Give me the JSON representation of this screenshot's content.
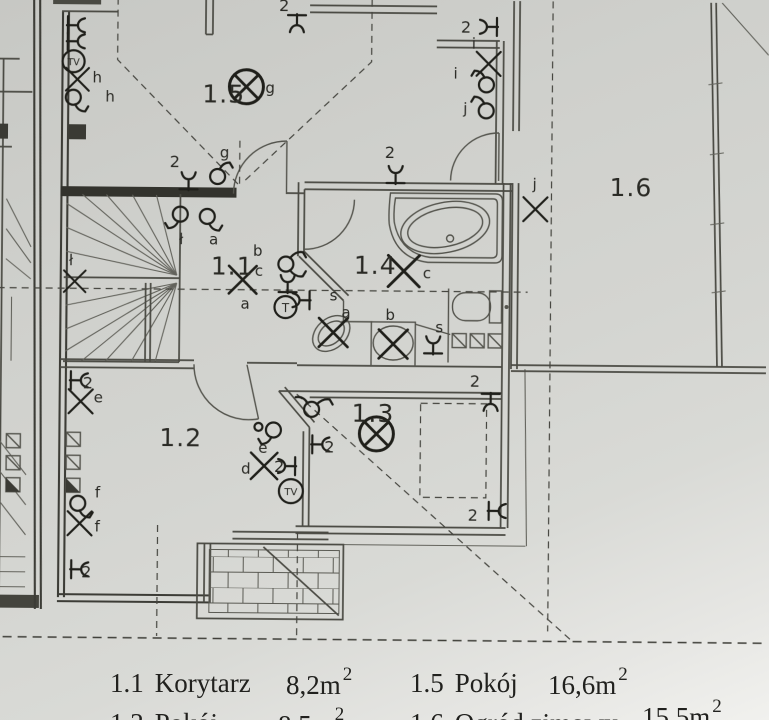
{
  "rooms": {
    "r11": {
      "num": "1.1",
      "name": "Korytarz",
      "area": "8,2m",
      "area_sup": "2"
    },
    "r12": {
      "num": "1.2",
      "name": "Pokój",
      "area": "8,5m",
      "area_sup": "2"
    },
    "r13": {
      "num": "1.3"
    },
    "r14": {
      "num": "1.4"
    },
    "r15": {
      "num": "1.5",
      "name": "Pokój",
      "area": "16,6m",
      "area_sup": "2"
    },
    "r16": {
      "num": "1.6",
      "name": "Ogród zimowy",
      "area": "15,5m",
      "area_sup": "2"
    }
  },
  "circuits": {
    "a": "a",
    "b": "b",
    "c": "c",
    "d": "d",
    "e": "e",
    "f": "f",
    "g": "g",
    "h": "h",
    "i": "i",
    "j": "j",
    "l": "ł",
    "s": "s"
  },
  "marks": {
    "double_socket": "2",
    "tv": "TV",
    "thermostat": "T"
  }
}
